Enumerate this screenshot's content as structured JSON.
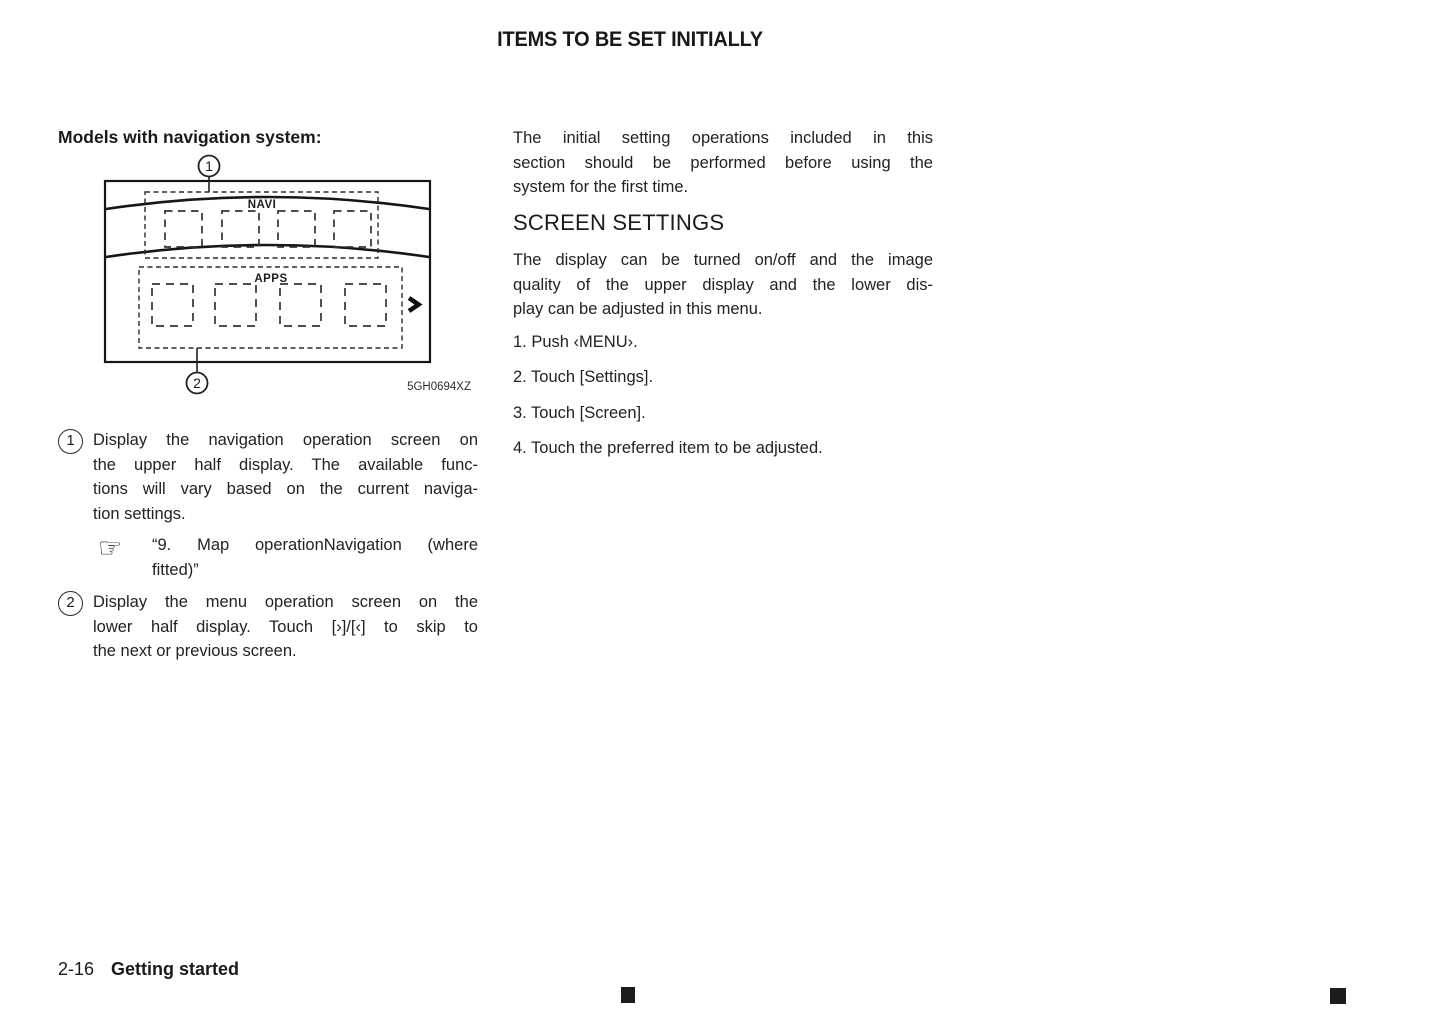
{
  "page": {
    "title": "ITEMS TO BE SET INITIALLY",
    "footer": {
      "page_number": "2-16",
      "section": "Getting started"
    }
  },
  "left_column": {
    "heading": "Models with navigation system:",
    "figure": {
      "navi_label": "NAVI",
      "apps_label": "APPS",
      "callout_1": "1",
      "callout_2": "2",
      "code": "5GH0694XZ"
    },
    "items": [
      {
        "number": "1",
        "lines": [
          "Display the navigation operation screen on",
          "the upper half display. The available func-",
          "tions will vary based on the current naviga-",
          "tion settings."
        ],
        "reference": {
          "icon": "☞",
          "lines": [
            "“9. Map operationNavigation (where",
            "fitted)”"
          ]
        }
      },
      {
        "number": "2",
        "lines": [
          "Display the menu operation screen on the",
          "lower half display. Touch [›]/[‹] to skip to",
          "the next or previous screen."
        ]
      }
    ]
  },
  "right_column": {
    "intro_lines": [
      "The initial setting operations included in this",
      "section should be performed before using the",
      "system for the first time."
    ],
    "section_heading": "SCREEN SETTINGS",
    "description_lines": [
      "The display can be turned on/off and the image",
      "quality of the upper display and the lower dis-",
      "play can be adjusted in this menu."
    ],
    "steps": [
      "1. Push ‹MENU›.",
      "2. Touch [Settings].",
      "3. Touch [Screen].",
      "4. Touch the preferred item to be adjusted."
    ]
  }
}
